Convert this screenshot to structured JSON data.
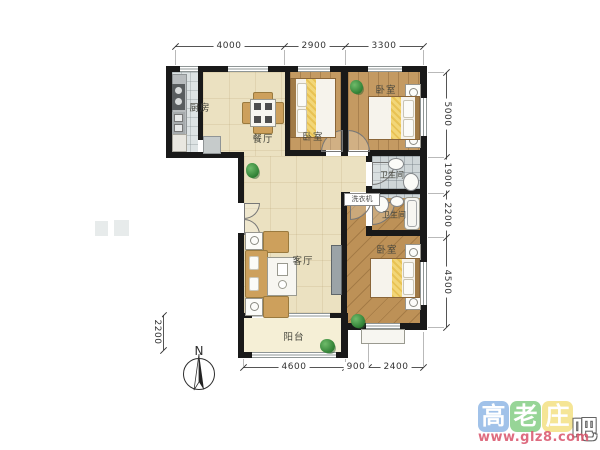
{
  "plan": {
    "rooms": {
      "kitchen": "厨房",
      "dining": "餐厅",
      "living": "客厅",
      "balcony": "阳台",
      "bedroom1": "卧室",
      "bedroom2": "卧室",
      "bedroom3": "卧室",
      "bath1": "卫生间",
      "bath2": "卫生间",
      "washer": "洗衣机"
    },
    "dims": {
      "top": [
        "4000",
        "2900",
        "3300"
      ],
      "right": [
        "5000",
        "1900",
        "2200",
        "4500"
      ],
      "bottom": [
        "4600",
        "900",
        "2400"
      ],
      "left": [
        "2200"
      ]
    },
    "compass": {
      "n": "N"
    }
  },
  "watermark": {
    "tiles": [
      {
        "char": "高",
        "color": "#8ab4e4"
      },
      {
        "char": "老",
        "color": "#7ecb7e"
      },
      {
        "char": "庄",
        "color": "#f3df7d"
      }
    ],
    "suffix": "吧",
    "url": "www.glz8.com"
  },
  "colors": {
    "wall": "#191919",
    "wood_floor": "#c49a62",
    "living_floor": "#ebe1c1",
    "balcony_floor": "#f5efd6",
    "kitchen_floor": "#dde3e4",
    "bath_floor": "#cfd6d8",
    "bed_accent": "#f2d678",
    "furniture_tan": "#cda05c",
    "plant_green": "#2e7e33",
    "dim_text": "#333333",
    "watermark_url_red": "#d9536a"
  }
}
